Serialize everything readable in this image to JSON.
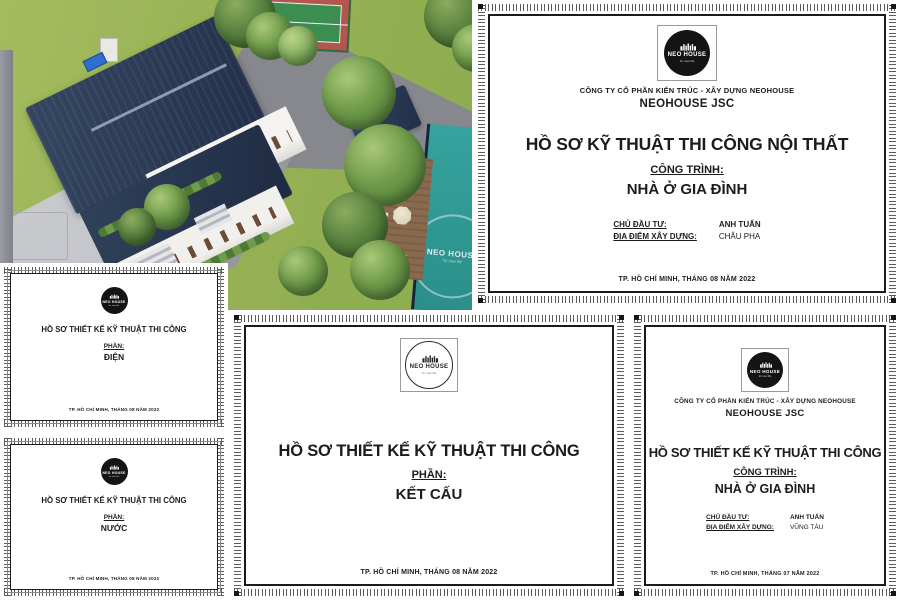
{
  "logo": {
    "name": "NEO HOUSE",
    "tagline": "for new life"
  },
  "colors": {
    "roof_navy": "#2b3a55",
    "pool_teal": "#2f9d98",
    "lawn_green": "#97b255",
    "deck_brown": "#8a6a4e",
    "court_green": "#3c8d50",
    "court_red": "#b2564e"
  },
  "docs": {
    "noi_that": {
      "company_line": "CÔNG TY CỔ PHẦN KIẾN TRÚC - XÂY DỰNG NEOHOUSE",
      "company_name": "NEOHOUSE JSC",
      "title": "HỒ SƠ KỸ THUẬT THI CÔNG NỘI THẤT",
      "project_label": "CÔNG TRÌNH:",
      "project_name": "NHÀ Ở GIA ĐÌNH",
      "owner_label": "CHỦ ĐẦU TƯ:",
      "owner_name": "ANH TUẤN",
      "location_label": "ĐỊA ĐIỂM XÂY DỰNG:",
      "location_name": "CHÂU PHA",
      "footer": "TP. HỒ CHÍ MINH, THÁNG 08 NĂM 2022"
    },
    "ket_cau": {
      "title": "HỒ SƠ THIẾT KẾ KỸ THUẬT THI CÔNG",
      "section_label": "PHẦN:",
      "section_name": "KẾT CẤU",
      "footer": "TP. HỒ CHÍ MINH, THÁNG 08 NĂM 2022"
    },
    "dien": {
      "title": "HỒ SƠ THIẾT KẾ KỸ THUẬT THI CÔNG",
      "section_label": "PHẦN:",
      "section_name": "ĐIỆN",
      "footer": "TP. HỒ CHÍ MINH, THÁNG 08 NĂM 2022"
    },
    "nuoc": {
      "title": "HỒ SƠ THIẾT KẾ KỸ THUẬT THI CÔNG",
      "section_label": "PHẦN:",
      "section_name": "NƯỚC",
      "footer": "TP. HỒ CHÍ MINH, THÁNG 08 NĂM 2022"
    },
    "gia_dinh": {
      "company_line": "CÔNG TY CỔ PHẦN KIẾN TRÚC - XÂY DỰNG NEOHOUSE",
      "company_name": "NEOHOUSE JSC",
      "title": "HỒ SƠ THIẾT KẾ KỸ THUẬT THI CÔNG",
      "project_label": "CÔNG TRÌNH:",
      "project_name": "NHÀ Ở GIA ĐÌNH",
      "owner_label": "CHỦ ĐẦU TƯ:",
      "owner_name": "ANH TUẤN",
      "location_label": "ĐỊA ĐIỂM XÂY DỰNG:",
      "location_name": "VŨNG TÀU",
      "footer": "TP. HỒ CHÍ MINH, THÁNG 07 NĂM 2022"
    }
  }
}
